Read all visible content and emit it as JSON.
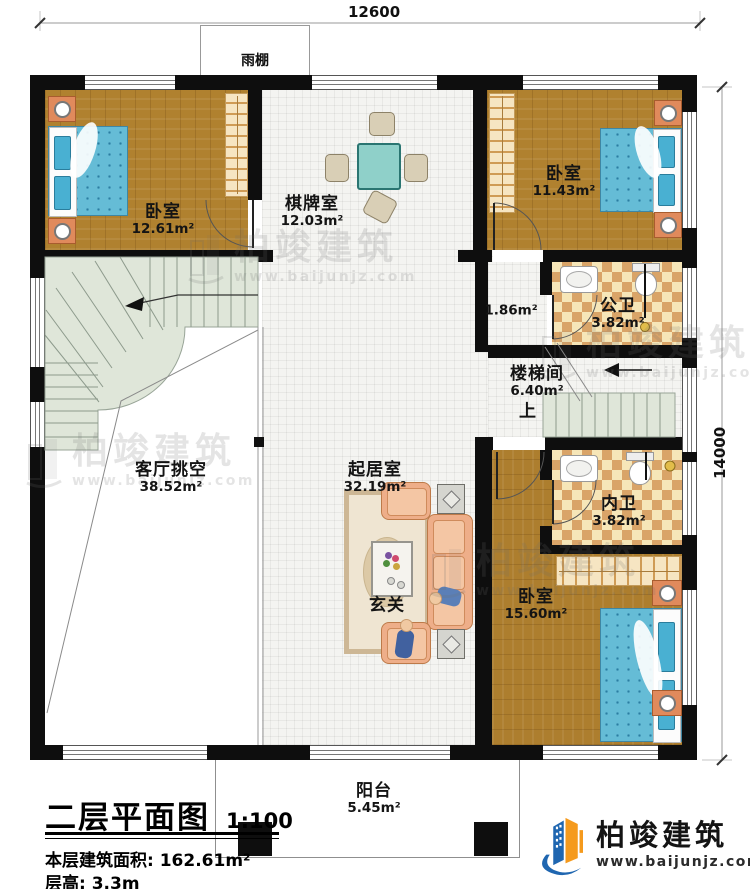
{
  "dimensions": {
    "top": "12600",
    "right": "14000"
  },
  "canopy": {
    "label": "雨棚"
  },
  "rooms": {
    "bedroom_tl": {
      "name": "卧室",
      "area": "12.61m²"
    },
    "chess": {
      "name": "棋牌室",
      "area": "12.03m²"
    },
    "bedroom_tr": {
      "name": "卧室",
      "area": "11.43m²"
    },
    "hallway": {
      "area": "1.86m²"
    },
    "public_bath": {
      "name": "公卫",
      "area": "3.82m²"
    },
    "stairwell": {
      "name": "楼梯间",
      "area": "6.40m²",
      "up": "上"
    },
    "inner_bath": {
      "name": "内卫",
      "area": "3.82m²"
    },
    "bedroom_br": {
      "name": "卧室",
      "area": "15.60m²"
    },
    "living_void": {
      "name": "客厅挑空",
      "area": "38.52m²"
    },
    "living": {
      "name": "起居室",
      "area": "32.19m²"
    },
    "foyer": {
      "name": "玄关"
    },
    "balcony": {
      "name": "阳台",
      "area": "5.45m²"
    }
  },
  "footer": {
    "title": "二层平面图",
    "scale": "1:100",
    "area_line": "本层建筑面积: 162.61m²",
    "floor_height_line": "层高: 3.3m"
  },
  "brand": {
    "name": "柏竣建筑",
    "url": "www.baijunjz.com"
  },
  "watermark": {
    "name": "柏竣建筑",
    "url": "www.baijunjz.com"
  },
  "colors": {
    "wall": "#0e0e0e",
    "wood": "#b0812f",
    "tile": "#f4f4f1",
    "checker_light": "#f6e6b8",
    "checker_dark": "#d9a468",
    "stairs": "#dfe6d9",
    "balcony_floor": "#f0ebd8",
    "bed_blue": "#65bcd6",
    "table_teal": "#8fd0c9",
    "sofa_peach": "#eeae89",
    "brand_blue": "#1f66b0",
    "brand_orange": "#f59a1d"
  }
}
